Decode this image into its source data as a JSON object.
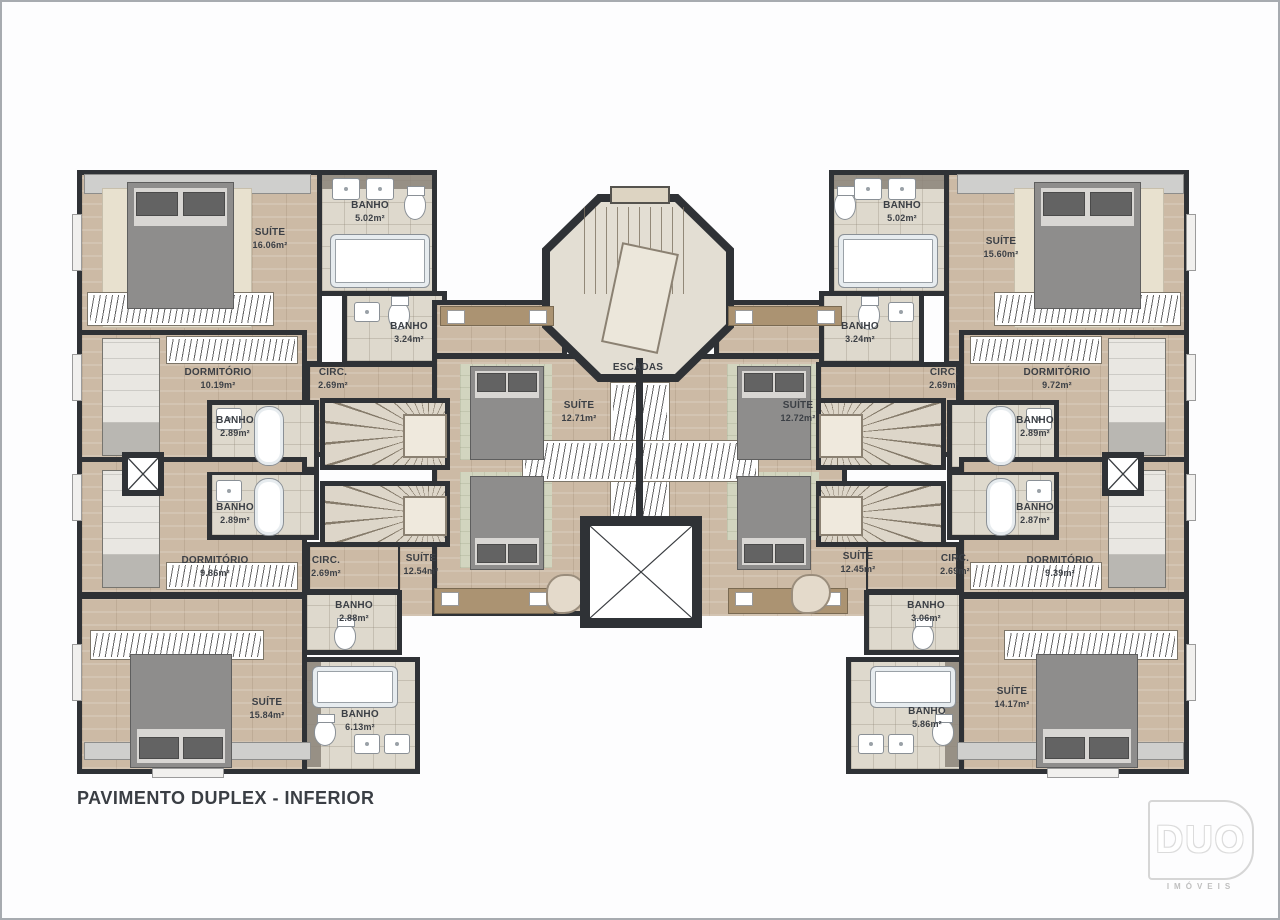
{
  "title": "PAVIMENTO DUPLEX - INFERIOR",
  "logo": {
    "brand": "DUO",
    "tagline": "IMÓVEIS"
  },
  "core": {
    "stairs_label": "ESCADAS"
  },
  "colors": {
    "wall": "#2f3236",
    "wood_floor": "#ccbaa5",
    "tile_floor": "#ded9cd",
    "rug": "#e8e1cf",
    "green_tile": "#d2d5bf",
    "label_text": "#3b3f45",
    "page_border": "#a7abb0"
  },
  "rooms": {
    "suite16": {
      "name": "SUÍTE",
      "area": "16.06m²"
    },
    "banho502L": {
      "name": "BANHO",
      "area": "5.02m²"
    },
    "banho324L": {
      "name": "BANHO",
      "area": "3.24m²"
    },
    "dorm1019": {
      "name": "DORMITÓRIO",
      "area": "10.19m²"
    },
    "circLU": {
      "name": "CIRC.",
      "area": "2.69m²"
    },
    "banho289LU": {
      "name": "BANHO",
      "area": "2.89m²"
    },
    "banho289LL": {
      "name": "BANHO",
      "area": "2.89m²"
    },
    "dorm986": {
      "name": "DORMITÓRIO",
      "area": "9.86m²"
    },
    "circLL": {
      "name": "CIRC.",
      "area": "2.69m²"
    },
    "suite1254": {
      "name": "SUÍTE",
      "area": "12.54m²"
    },
    "banho288": {
      "name": "BANHO",
      "area": "2.88m²"
    },
    "suite1584": {
      "name": "SUÍTE",
      "area": "15.84m²"
    },
    "banho613": {
      "name": "BANHO",
      "area": "6.13m²"
    },
    "suite1271": {
      "name": "SUÍTE",
      "area": "12.71m²"
    },
    "suite1272": {
      "name": "SUÍTE",
      "area": "12.72m²"
    },
    "banho502R": {
      "name": "BANHO",
      "area": "5.02m²"
    },
    "suite1560": {
      "name": "SUÍTE",
      "area": "15.60m²"
    },
    "banho324R": {
      "name": "BANHO",
      "area": "3.24m²"
    },
    "circRU": {
      "name": "CIRC.",
      "area": "2.69m²"
    },
    "dorm972": {
      "name": "DORMITÓRIO",
      "area": "9.72m²"
    },
    "banho289RU": {
      "name": "BANHO",
      "area": "2.89m²"
    },
    "banho287R": {
      "name": "BANHO",
      "area": "2.87m²"
    },
    "suite1245": {
      "name": "SUÍTE",
      "area": "12.45m²"
    },
    "circRL": {
      "name": "CIRC.",
      "area": "2.69m²"
    },
    "dorm939": {
      "name": "DORMITÓRIO",
      "area": "9.39m²"
    },
    "banho306": {
      "name": "BANHO",
      "area": "3.06m²"
    },
    "suite1417": {
      "name": "SUÍTE",
      "area": "14.17m²"
    },
    "banho586": {
      "name": "BANHO",
      "area": "5.86m²"
    }
  }
}
